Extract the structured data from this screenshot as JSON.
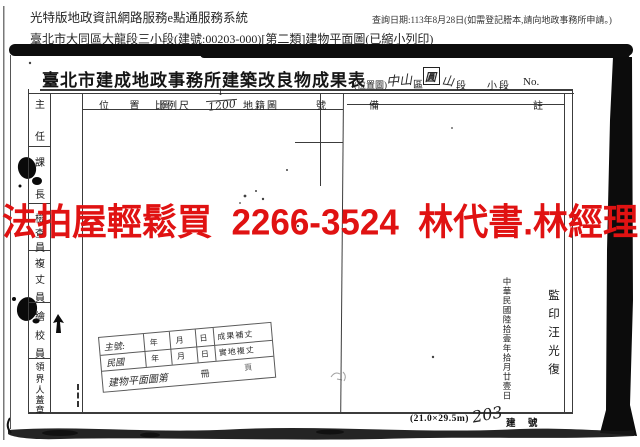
{
  "header": {
    "system_title": "光特版地政資訊網路服務e點通服務系統",
    "query_date": "查詢日期:113年8月28日(如需登記謄本,請向地政事務所申請。)",
    "doc_line": "臺北市大同區大龍段三小段(建號:00203-000)[第二類]建物平面圖(已縮小列印)"
  },
  "watermark": {
    "text": "法拍屋輕鬆買  2266-3524  林代書.林經理",
    "color": "#e01212"
  },
  "form": {
    "title": "臺北市建成地政事務所建築改良物成果表",
    "location_note": "(位置圖)",
    "district_value": "中山",
    "district_label": "區",
    "section_char": "圓",
    "section_char2": "山",
    "section_label": "段",
    "subsection_label": "小段",
    "no_label": "No.",
    "cols": {
      "position_map": "位 置 圖",
      "scale_label": "比例尺",
      "scale_num": "1",
      "scale_den": "1200",
      "cadastral": "地籍圖",
      "number": "號",
      "remark_left": "備",
      "remark_right": "註"
    },
    "staff": [
      "主",
      "任",
      "課",
      "長",
      "檢",
      "查",
      "員",
      "複",
      "丈",
      "員",
      "繪",
      "校",
      "員",
      "領",
      "界",
      "人",
      "蓋",
      "章"
    ]
  },
  "mini_table": {
    "main_no": "主號:",
    "minguo": "民國",
    "year": "年",
    "month": "月",
    "day": "日",
    "row1_right": "成果補丈",
    "row2_right": "實地複丈",
    "row3": "建物平面圖第",
    "book": "冊",
    "page": "頁"
  },
  "stamps": {
    "date": "中華民國陸拾壹年拾月廿壹日",
    "seal": "監印汪光復"
  },
  "footer": {
    "paper_size": "(21.0×29.5m)",
    "building_no": "203",
    "building_no_label": "建 號"
  }
}
